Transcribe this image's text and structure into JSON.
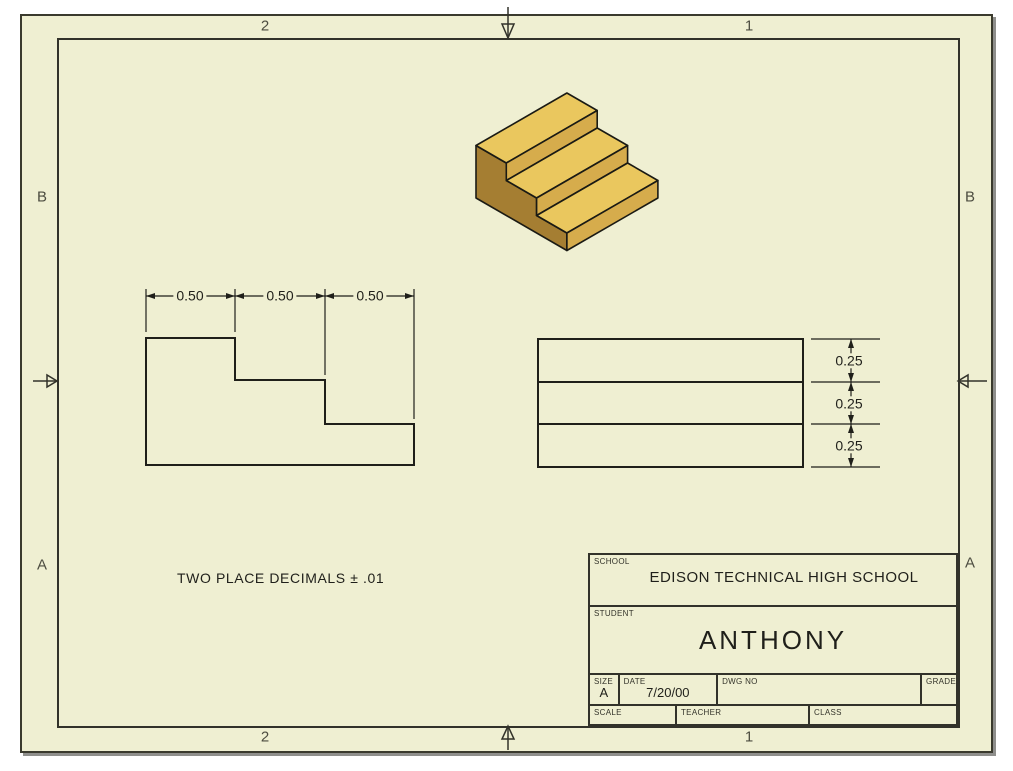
{
  "sheet": {
    "zones": {
      "top_left": "2",
      "top_right": "1",
      "bottom_left": "2",
      "bottom_right": "1",
      "left_top": "B",
      "left_bottom": "A",
      "right_top": "B",
      "right_bottom": "A"
    },
    "note": "TWO PLACE DECIMALS ± .01"
  },
  "views": {
    "isometric": {
      "name": "stepped-block"
    },
    "front": {
      "dims": [
        "0.50",
        "0.50",
        "0.50"
      ]
    },
    "side": {
      "dims": [
        "0.25",
        "0.25",
        "0.25"
      ]
    }
  },
  "title_block": {
    "school_label": "SCHOOL",
    "school": "EDISON TECHNICAL HIGH SCHOOL",
    "student_label": "STUDENT",
    "student": "ANTHONY",
    "size_label": "SIZE",
    "size": "A",
    "date_label": "DATE",
    "date": "7/20/00",
    "dwg_no_label": "DWG NO",
    "dwg_no": "",
    "grade_label": "GRADE",
    "grade": "",
    "scale_label": "SCALE",
    "scale": "",
    "teacher_label": "TEACHER",
    "teacher": "",
    "class_label": "CLASS",
    "class": ""
  },
  "colors": {
    "sheet_bg": "#EFEFD2",
    "line": "#1f1f1a",
    "frame_line": "#32322a",
    "iso_top": "#EAC75E",
    "iso_riser": "#D6AC4C",
    "iso_side": "#A57E32"
  }
}
